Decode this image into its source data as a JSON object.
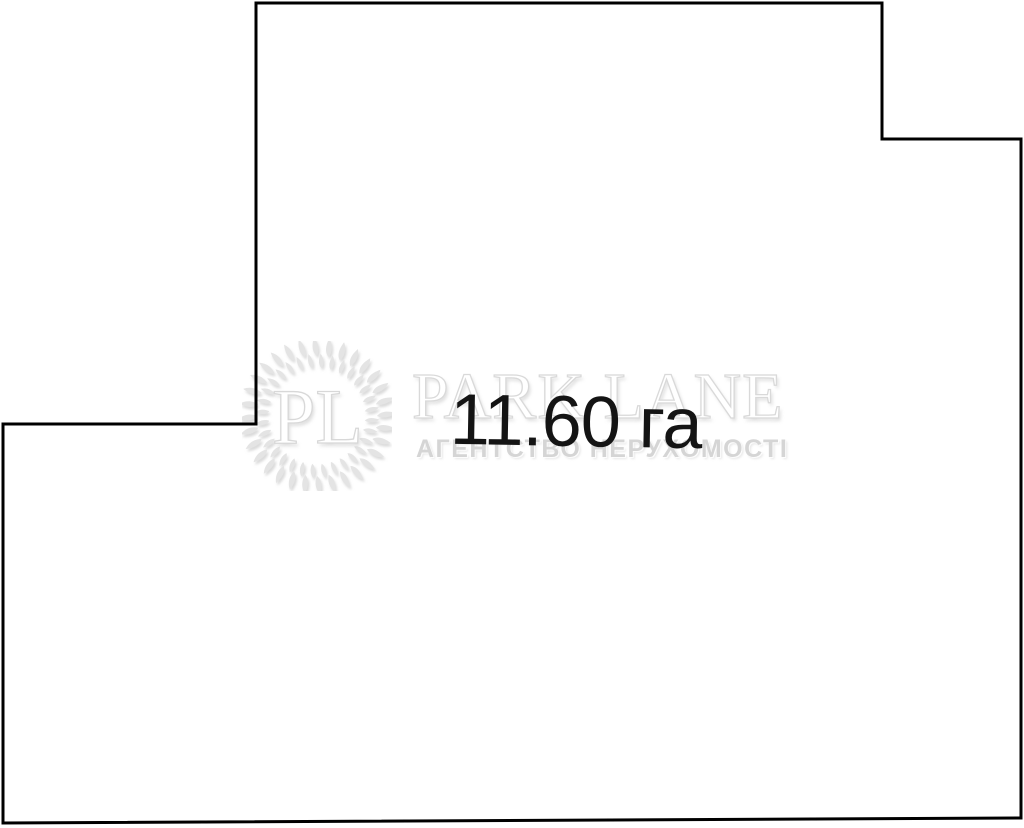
{
  "diagram": {
    "area_label": "11.60 га",
    "boundary_color": "#000000",
    "area_label_color": "#141414",
    "background_color": "#ffffff"
  },
  "watermark": {
    "monogram": "PL",
    "brand": "PARK LANE",
    "tagline": "АГЕНТСТВО НЕРУХОМОСТІ",
    "color": "#d9d9d9"
  }
}
